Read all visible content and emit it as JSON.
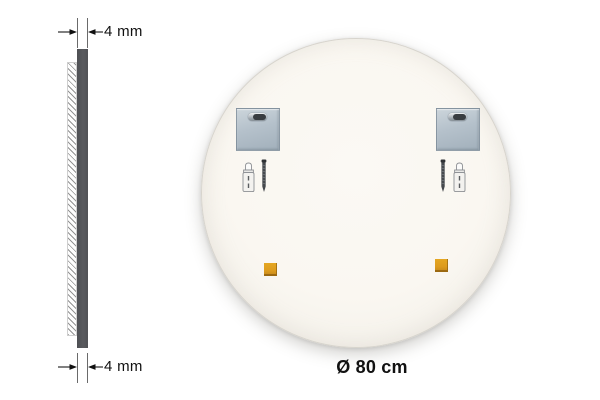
{
  "side_view": {
    "top_dimension": {
      "label": "4 mm"
    },
    "bottom_dimension": {
      "label": "4 mm"
    },
    "parts": [
      "glass-edge",
      "backing-board-hatch"
    ]
  },
  "mirror_back": {
    "diameter_label": "Ø 80 cm",
    "components": [
      "mounting-bracket-with-keyhole-slot-left",
      "mounting-bracket-with-keyhole-slot-right",
      "wall-anchor-left",
      "screw-left",
      "screw-right",
      "wall-anchor-right",
      "adhesive-pad-left",
      "adhesive-pad-right"
    ]
  },
  "colors": {
    "glass_edge": "#595a5e",
    "bracket_metal": "#b5c1cb",
    "adhesive_pad": "#dd9b1e",
    "mirror_back": "#faf7f1",
    "annotation": "#111111"
  }
}
